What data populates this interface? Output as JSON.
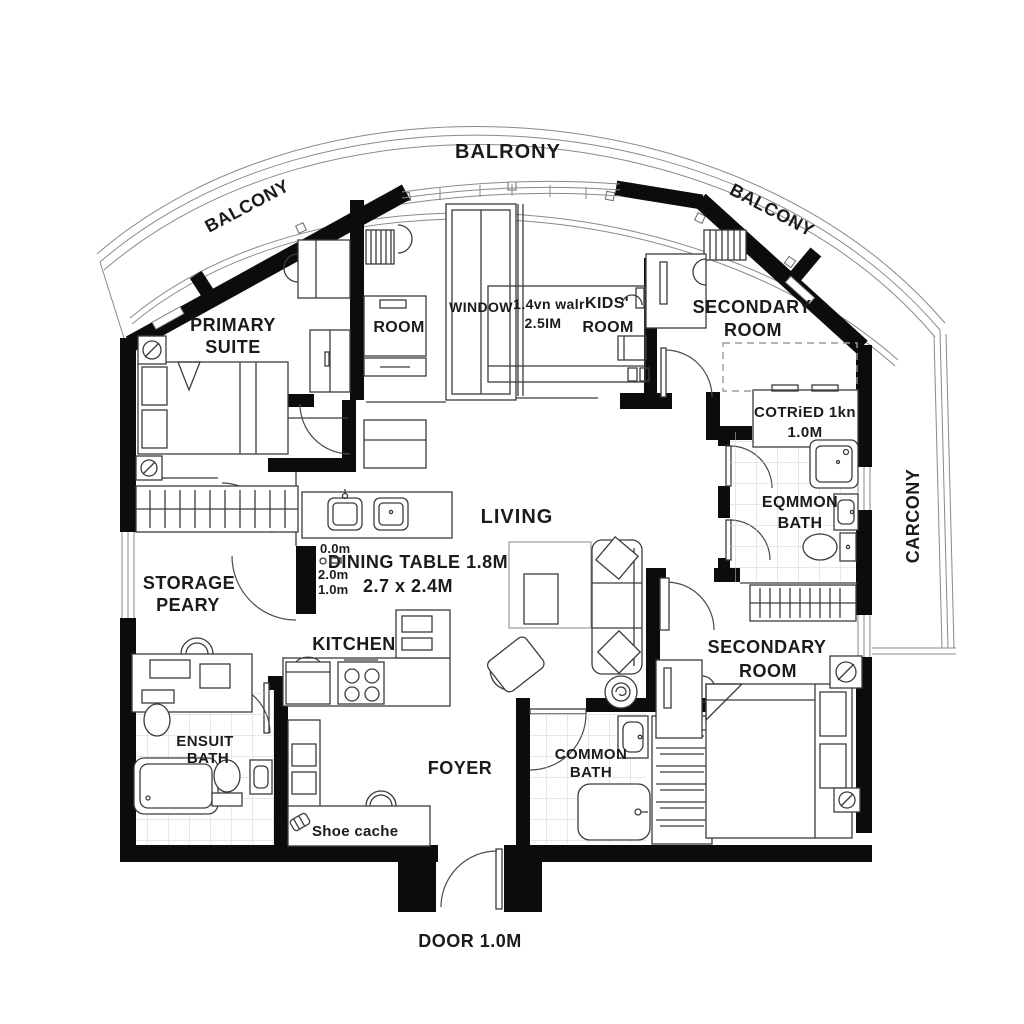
{
  "colors": {
    "wall": "#0c0c0c",
    "furniture_line": "#3c3c3c",
    "tile_line": "#cfcfcf",
    "text": "#1b1b1b",
    "background": "#ffffff"
  },
  "balcony": {
    "top": "BALRONY",
    "left": "BALCONY",
    "right": "BALCONY",
    "side": "CARCONY"
  },
  "rooms": {
    "primary_suite": {
      "l1": "PRIMARY",
      "l2": "SUITE"
    },
    "room": {
      "l1": "ROOM"
    },
    "window": {
      "l1": "WINDOW"
    },
    "wall_note": {
      "l1": "1.4vn walr",
      "l2": "2.5IM"
    },
    "kids_room": {
      "l1": "KIDS'",
      "l2": "ROOM"
    },
    "secondary_room_top": {
      "l1": "SECONDARY",
      "l2": "ROOM"
    },
    "cotried": {
      "l1": "COTRiED 1kn",
      "l2": "1.0M"
    },
    "eqmmon_bath": {
      "l1": "EQMMON",
      "l2": "BATH"
    },
    "living": {
      "l1": "LIVING"
    },
    "dining": {
      "l1": "DINING TABLE 1.8M",
      "l2": "2.7 x 2.4M"
    },
    "dims": {
      "d1": "0.0m",
      "d2": "2.0m",
      "d3": "1.0m"
    },
    "storage": {
      "l1": "STORAGE",
      "l2": "PEARY"
    },
    "kitchen": {
      "l1": "KITCHEN"
    },
    "ensuite_bath": {
      "l1": "ENSUIT",
      "l2": "BATH"
    },
    "shoe": {
      "l1": "Shoe cache"
    },
    "foyer": {
      "l1": "FOYER"
    },
    "common_bath": {
      "l1": "COMMON",
      "l2": "BATH"
    },
    "secondary_room_bottom": {
      "l1": "SECONDARY",
      "l2": "ROOM"
    },
    "entry": {
      "l1": "DOOR 1.0M"
    }
  }
}
